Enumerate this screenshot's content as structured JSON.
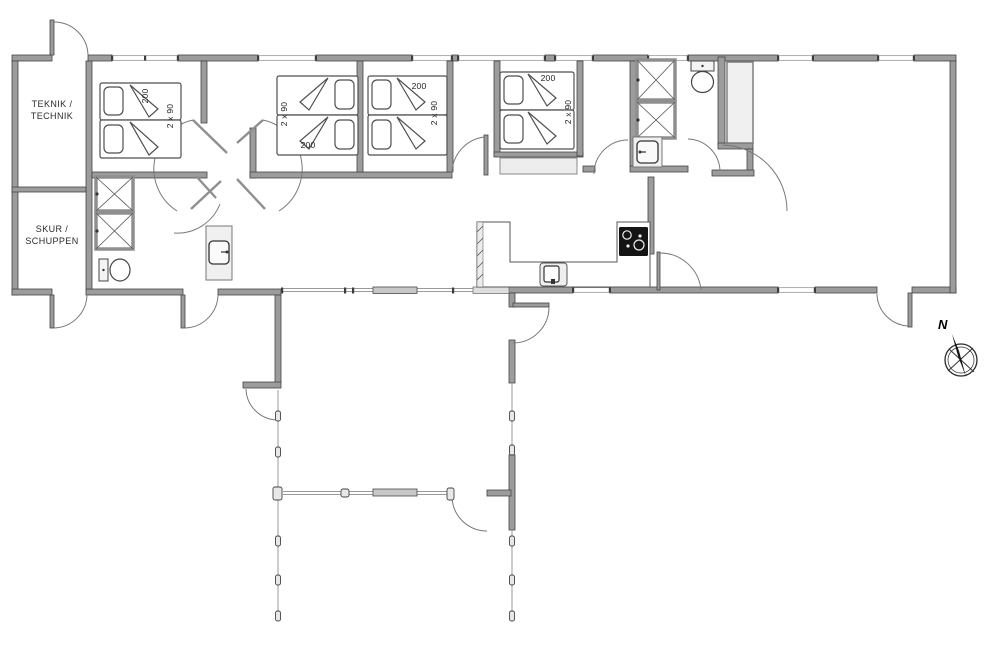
{
  "plan": {
    "rooms": {
      "teknik": {
        "line1": "TEKNIK /",
        "line2": "TECHNIK"
      },
      "skur": {
        "line1": "SKUR /",
        "line2": "SCHUPPEN"
      }
    },
    "bed_labels": {
      "length": "200",
      "width": "2 x 90"
    },
    "compass": {
      "north": "N"
    },
    "colors": {
      "background": "#ffffff",
      "wall_fill": "#9c9c9c",
      "wall_edge": "#454545",
      "door_arc": "#787878",
      "fixture_fill": "#f0f0f0",
      "cooktop": "#141414",
      "label_text": "#2a2a2a"
    }
  }
}
